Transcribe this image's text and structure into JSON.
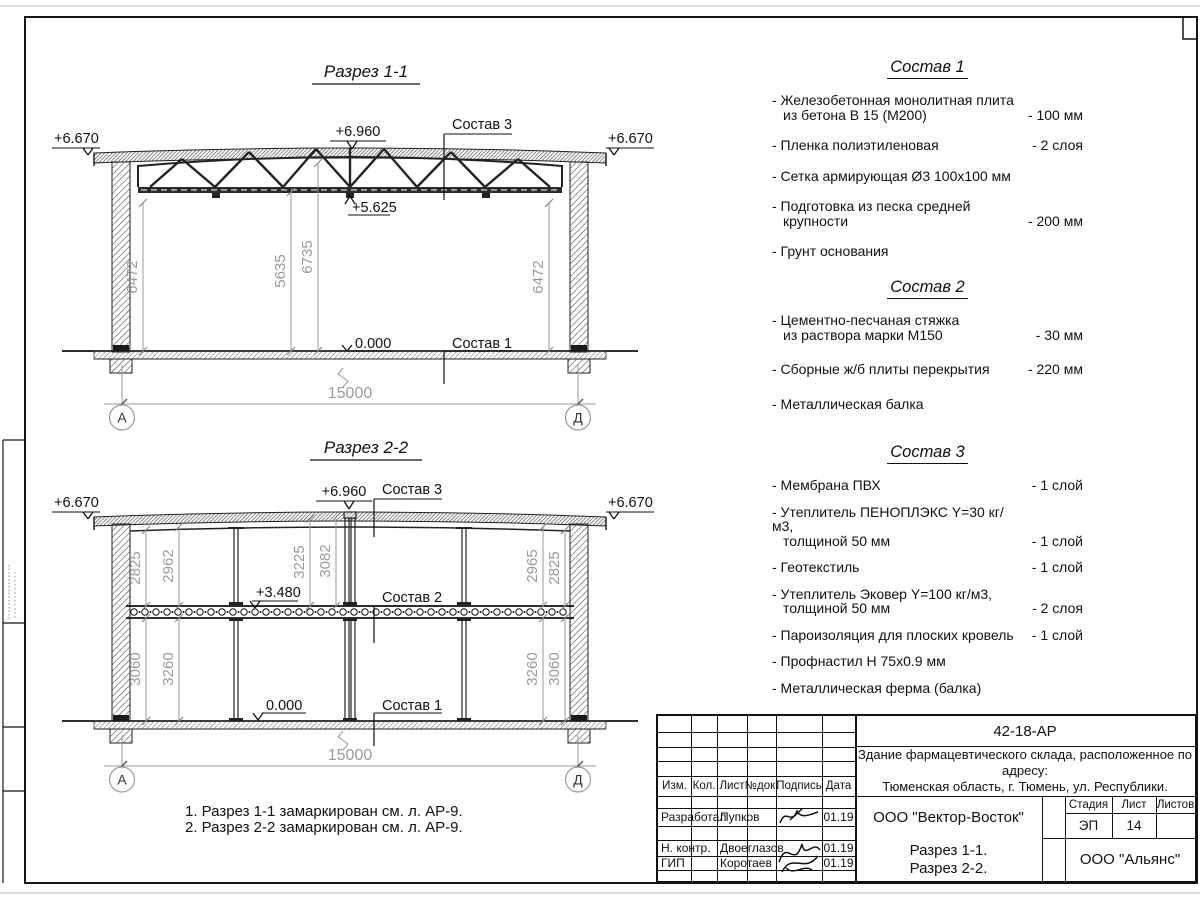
{
  "section1": {
    "title": "Разрез 1-1",
    "elev_left": "+6.670",
    "elev_right": "+6.670",
    "elev_ridge": "+6.960",
    "elev_truss_bottom": "+5.625",
    "elev_floor": "0.000",
    "callout_roof": "Состав 3",
    "callout_floor": "Состав 1",
    "dim_heights": [
      "6472",
      "5635",
      "6735",
      "6472"
    ],
    "dim_span": "15000",
    "axis_left": "А",
    "axis_right": "Д"
  },
  "section2": {
    "title": "Разрез 2-2",
    "elev_left": "+6.670",
    "elev_right": "+6.670",
    "elev_ridge": "+6.960",
    "elev_mid": "+3.480",
    "elev_floor": "0.000",
    "callout_roof": "Состав 3",
    "callout_mid": "Состав 2",
    "callout_floor": "Состав 1",
    "dims_upper": [
      "2825",
      "2962",
      "3225",
      "3082",
      "2965",
      "2825"
    ],
    "dims_lower": [
      "3060",
      "3260",
      "3260",
      "3060"
    ],
    "dim_span": "15000",
    "axis_left": "А",
    "axis_right": "Д"
  },
  "compositions": [
    {
      "title": "Состав 1",
      "items": [
        {
          "line1": "- Железобетонная  монолитная плита",
          "line2": "из бетона В 15 (М200)",
          "value": "- 100 мм"
        },
        {
          "line1": "- Пленка полиэтиленовая",
          "line2": "",
          "value": "-  2 слоя"
        },
        {
          "line1": "- Сетка армирующая Ø3 100х100 мм",
          "line2": "",
          "value": ""
        },
        {
          "line1": "- Подготовка из песка средней",
          "line2": "крупности",
          "value": "- 200 мм"
        },
        {
          "line1": "- Грунт основания",
          "line2": "",
          "value": ""
        }
      ]
    },
    {
      "title": "Состав 2",
      "items": [
        {
          "line1": "- Цементно-песчаная стяжка",
          "line2": "из раствора марки М150",
          "value": "- 30 мм"
        },
        {
          "line1": "- Сборные ж/б плиты перекрытия",
          "line2": "",
          "value": "- 220 мм"
        },
        {
          "line1": "- Металлическая балка",
          "line2": "",
          "value": ""
        }
      ]
    },
    {
      "title": "Состав 3",
      "items": [
        {
          "line1": "- Мембрана ПВХ",
          "line2": "",
          "value": "- 1 слой"
        },
        {
          "line1": "- Утеплитель ПЕНОПЛЭКС Y=30 кг/м3,",
          "line2": "толщиной 50 мм",
          "value": "- 1 слой"
        },
        {
          "line1": "- Геотекстиль",
          "line2": "",
          "value": "- 1 слой"
        },
        {
          "line1": "- Утеплитель Эковер Y=100 кг/м3,",
          "line2": "толщиной 50 мм",
          "value": "- 2 слоя"
        },
        {
          "line1": "- Пароизоляция для плоских кровель",
          "line2": "",
          "value": "- 1 слой"
        },
        {
          "line1": "- Профнастил Н 75х0.9 мм",
          "line2": "",
          "value": ""
        },
        {
          "line1": "- Металлическая ферма (балка)",
          "line2": "",
          "value": ""
        }
      ]
    }
  ],
  "notes": {
    "line1": "1. Разрез 1-1 замаркирован см. л. АР-9.",
    "line2": "2. Разрез 2-2 замаркирован см. л. АР-9."
  },
  "titleblock": {
    "doc_number": "42-18-АР",
    "description_line1": "Здание фармацевтического склада, расположенное по адресу:",
    "description_line2": "Тюменская область, г. Тюмень, ул. Республики.",
    "header": {
      "izm": "Изм.",
      "kol": "Кол.",
      "list": "Лист",
      "ndok": "№док.",
      "podpis": "Подпись",
      "data": "Дата"
    },
    "rows": [
      {
        "role": "Разработал",
        "name": "Пупков",
        "date": "01.19"
      },
      {
        "role": "Н. контр.",
        "name": "Двоеглазов",
        "date": "01.19"
      },
      {
        "role": "ГИП",
        "name": "Коротаев",
        "date": "01.19"
      }
    ],
    "org": "ООО \"Вектор-Восток\"",
    "stage_label": "Стадия",
    "sheet_label": "Лист",
    "sheets_label": "Листов",
    "stage": "ЭП",
    "sheet_num": "14",
    "sheets_total": "",
    "subject_line1": "Разрез 1-1.",
    "subject_line2": "Разрез 2-2.",
    "contractor": "ООО \"Альянс\""
  },
  "colors": {
    "line": "#1a1a1a",
    "dim_gray": "#9a9a9a",
    "paper": "#ffffff"
  }
}
